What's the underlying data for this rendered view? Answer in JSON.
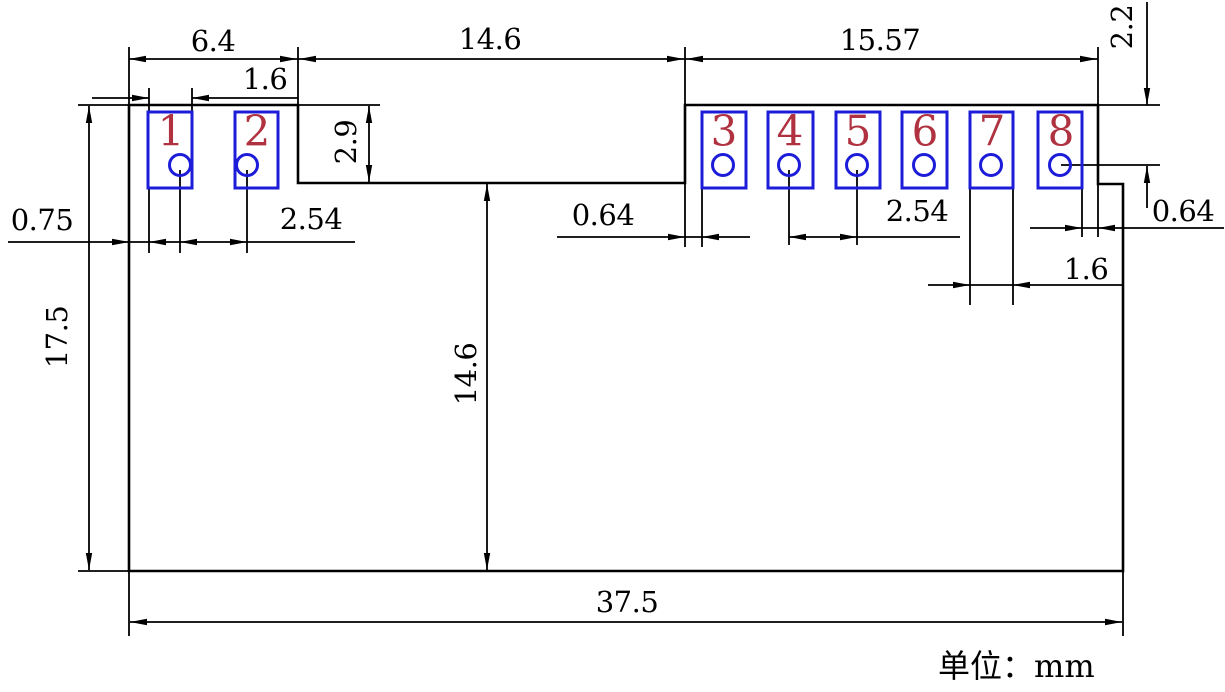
{
  "note": {
    "unit": "单位：mm"
  },
  "pads": [
    "1",
    "2",
    "3",
    "4",
    "5",
    "6",
    "7",
    "8"
  ],
  "dims": {
    "section_left_width": "6.4",
    "center_gap_width": "14.6",
    "section_right_width": "15.57",
    "pad1_width": "1.6",
    "step_depth": "2.9",
    "edge_to_pad1": "0.75",
    "pitch_left": "2.54",
    "edge_to_pad3_gap": "0.64",
    "pitch_right": "2.54",
    "pad7_width": "1.6",
    "pad8_edge_gap": "0.64",
    "top_to_hole_center": "2.2",
    "overall_height": "17.5",
    "step_to_bottom_height": "14.6",
    "overall_width": "37.5"
  },
  "colors": {
    "line": "#000000",
    "pad_outline": "#1c1cd9",
    "pin_number": "#b03240",
    "background": "#ffffff"
  }
}
